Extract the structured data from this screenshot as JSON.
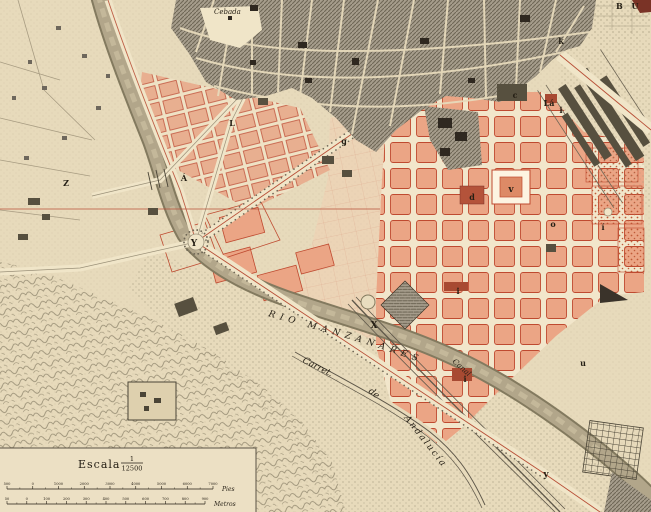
{
  "labels": {
    "cebada": "Cebada",
    "top_right": "B U",
    "river": "RIO MANZANARES",
    "canal": "Canal",
    "carret": "Carret.",
    "de": "de",
    "andalucia": "Andalucía"
  },
  "scale": {
    "escala": "Escala",
    "num": "1",
    "den": "12500",
    "pies_unit": "Pies",
    "metros_unit": "Metros",
    "pies_ticks": [
      "500",
      "0",
      "1000",
      "2000",
      "3000",
      "4000",
      "5000",
      "6000",
      "7000"
    ],
    "metros_ticks": [
      "50",
      "0",
      "100",
      "200",
      "300",
      "400",
      "500",
      "600",
      "700",
      "800",
      "900"
    ]
  },
  "markers": [
    {
      "ch": "Z",
      "x": 66,
      "y": 186,
      "s": 8
    },
    {
      "ch": "Á",
      "x": 184,
      "y": 181,
      "s": 8
    },
    {
      "ch": "Y",
      "x": 194,
      "y": 246,
      "s": 9
    },
    {
      "ch": "L",
      "x": 232,
      "y": 126,
      "s": 8
    },
    {
      "ch": "g",
      "x": 344,
      "y": 144,
      "s": 8
    },
    {
      "ch": "k",
      "x": 561,
      "y": 44,
      "s": 8
    },
    {
      "ch": "c",
      "x": 515,
      "y": 98,
      "s": 8
    },
    {
      "ch": "Lá",
      "x": 549,
      "y": 106,
      "s": 8
    },
    {
      "ch": "i",
      "x": 561,
      "y": 113,
      "s": 8
    },
    {
      "ch": "v",
      "x": 511,
      "y": 192,
      "s": 9
    },
    {
      "ch": "d",
      "x": 472,
      "y": 200,
      "s": 8
    },
    {
      "ch": "o",
      "x": 553,
      "y": 227,
      "s": 8
    },
    {
      "ch": "í",
      "x": 603,
      "y": 230,
      "s": 8
    },
    {
      "ch": "i",
      "x": 458,
      "y": 294,
      "s": 8
    },
    {
      "ch": "X",
      "x": 374,
      "y": 328,
      "s": 9
    },
    {
      "ch": "u",
      "x": 583,
      "y": 366,
      "s": 8
    },
    {
      "ch": "i",
      "x": 465,
      "y": 382,
      "s": 8
    },
    {
      "ch": "y",
      "x": 546,
      "y": 477,
      "s": 9
    }
  ],
  "colors": {
    "paper": "#e7dabb",
    "streets": "#f2e6cb",
    "city_ink": "#6f6756",
    "new_town_block": "#eba585",
    "plan_line": "#bf4a30",
    "river": "#b2a68a",
    "ink": "#241e14"
  }
}
